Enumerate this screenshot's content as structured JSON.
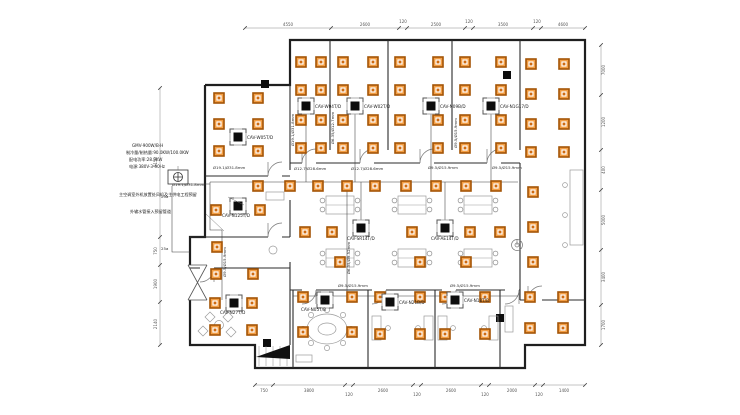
{
  "drawing": {
    "spec_block": [
      "GMV-900W/B-H",
      "制冷量/制热量:90.0KW/100.0KW",
      "配电功率:28.9KW",
      "电源:380V-3-50Hz"
    ],
    "notes": [
      "主空调室外机放置处风机及主供电工程预留",
      "外输水管接入预留管道"
    ],
    "units": {
      "l1": "CAV-W05T/D",
      "t1": "CAV-W04T/D",
      "t2": "CAV-W02T/D",
      "t3": "CAV-N09B/D",
      "t4": "CAV-N1G17/D",
      "l2": "CAV-N125T/D",
      "m1": "CAV-SR14T/D",
      "m2": "CAV-AE14T/D",
      "l3": "CAV-N27T/D",
      "b1": "CAV-N05T/B",
      "b2": "CAV-N21B/D",
      "b3": "CAV-N18T/B"
    },
    "pipe_labels": {
      "p1": "Ø19.1/Ø31.8mm",
      "p2": "Ø12.7/Ø28.6mm",
      "p3": "Ø12.7/Ø28.6mm",
      "p4": "Ø9.5/Ø15.9mm",
      "p5": "Ø9.5/Ø15.9mm",
      "p6": "Ø19.1/Ø31.8mm",
      "v1": "Ø19.1/Ø31.8mm",
      "v2": "Ø9.5/Ø15.9mm",
      "v3": "Ø6.35/Ø12.7mm",
      "v4": "Ø9.5/Ø15.9mm",
      "v5": "Ø6.35/Ø9.52mm",
      "pb1": "Ø9.5/Ø15.9mm",
      "pb2": "Ø9.5/Ø15.9mm",
      "r1": "25a",
      "r2": "25a"
    },
    "dims": {
      "top": [
        "4550",
        "2600",
        "120",
        "2500",
        "120",
        "3500",
        "120",
        "4600"
      ],
      "bottom": [
        "750",
        "3800",
        "120",
        "2600",
        "120",
        "2600",
        "120",
        "2000",
        "120",
        "1400"
      ],
      "left": [
        "6150",
        "750",
        "1900",
        "2140"
      ],
      "right": [
        "7000",
        "1200",
        "400",
        "5000",
        "3400",
        "1700"
      ]
    },
    "colors": {
      "diffuser_fill": "#f29e45",
      "diffuser_ring": "#a35406",
      "diffuser_core": "#cf6a10",
      "wall": "#1f1f1f",
      "dim_line": "#888888"
    },
    "symbols": {
      "diffusers": [
        [
          219,
          98
        ],
        [
          258,
          98
        ],
        [
          219,
          124
        ],
        [
          258,
          124
        ],
        [
          219,
          151
        ],
        [
          258,
          151
        ],
        [
          301,
          62
        ],
        [
          321,
          62
        ],
        [
          301,
          90
        ],
        [
          321,
          90
        ],
        [
          301,
          120
        ],
        [
          321,
          120
        ],
        [
          301,
          148
        ],
        [
          321,
          148
        ],
        [
          343,
          62
        ],
        [
          373,
          62
        ],
        [
          343,
          90
        ],
        [
          373,
          90
        ],
        [
          343,
          120
        ],
        [
          373,
          120
        ],
        [
          343,
          148
        ],
        [
          373,
          148
        ],
        [
          400,
          62
        ],
        [
          438,
          62
        ],
        [
          400,
          90
        ],
        [
          438,
          90
        ],
        [
          400,
          120
        ],
        [
          438,
          120
        ],
        [
          400,
          148
        ],
        [
          438,
          148
        ],
        [
          465,
          62
        ],
        [
          501,
          62
        ],
        [
          465,
          90
        ],
        [
          501,
          90
        ],
        [
          465,
          120
        ],
        [
          501,
          120
        ],
        [
          465,
          148
        ],
        [
          501,
          148
        ],
        [
          531,
          64
        ],
        [
          564,
          64
        ],
        [
          531,
          94
        ],
        [
          564,
          94
        ],
        [
          531,
          124
        ],
        [
          564,
          124
        ],
        [
          531,
          152
        ],
        [
          564,
          152
        ],
        [
          533,
          192
        ],
        [
          533,
          227
        ],
        [
          533,
          262
        ],
        [
          258,
          186
        ],
        [
          290,
          186
        ],
        [
          318,
          186
        ],
        [
          347,
          186
        ],
        [
          375,
          186
        ],
        [
          406,
          186
        ],
        [
          436,
          186
        ],
        [
          466,
          186
        ],
        [
          496,
          186
        ],
        [
          305,
          232
        ],
        [
          332,
          232
        ],
        [
          412,
          232
        ],
        [
          470,
          232
        ],
        [
          500,
          232
        ],
        [
          340,
          262
        ],
        [
          420,
          262
        ],
        [
          466,
          262
        ],
        [
          216,
          210
        ],
        [
          260,
          210
        ],
        [
          217,
          247
        ],
        [
          216,
          274
        ],
        [
          253,
          274
        ],
        [
          215,
          303
        ],
        [
          252,
          303
        ],
        [
          215,
          330
        ],
        [
          252,
          330
        ],
        [
          303,
          297
        ],
        [
          352,
          297
        ],
        [
          303,
          332
        ],
        [
          352,
          332
        ],
        [
          380,
          297
        ],
        [
          420,
          297
        ],
        [
          380,
          334
        ],
        [
          420,
          334
        ],
        [
          445,
          297
        ],
        [
          485,
          297
        ],
        [
          445,
          334
        ],
        [
          485,
          334
        ],
        [
          530,
          297
        ],
        [
          563,
          297
        ],
        [
          530,
          328
        ],
        [
          563,
          328
        ]
      ]
    }
  }
}
